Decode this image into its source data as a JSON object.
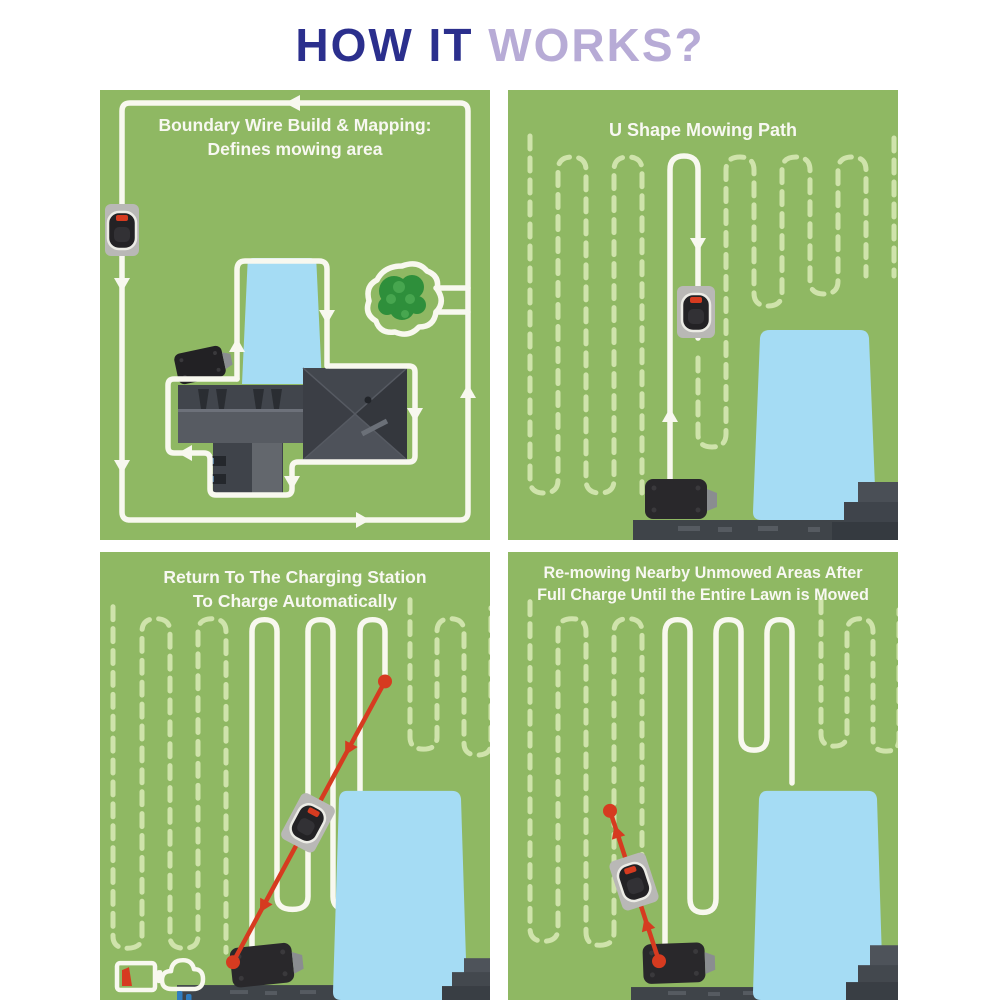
{
  "title": {
    "part1": "HOW IT",
    "part2": " WORKS?"
  },
  "panels": {
    "boundary": {
      "line1": "Boundary Wire Build & Mapping:",
      "line2": "Defines mowing area"
    },
    "ushape": {
      "line1": "U Shape Mowing Path",
      "line2": ""
    },
    "return_station": {
      "line1": "Return To The Charging Station",
      "line2": "To Charge Automatically"
    },
    "remowing": {
      "line1": "Re-mowing Nearby Unmowed Areas After",
      "line2": "Full Charge Until the Entire Lawn is Mowed"
    }
  },
  "colors": {
    "title_primary": "#2b2f8d",
    "title_secondary": "#b7abd6",
    "lawn_green": "#8fb863",
    "mowed_path_white": "#f8f8ef",
    "unmowed_dash_green": "#cfe3ab",
    "pool_blue": "#a5dcf4",
    "route_red": "#d63b20",
    "panel_title_white": "#f8f8f2",
    "station_black": "#29282b",
    "roof_gray": "#43474e"
  },
  "legend_icons": {
    "low_battery": "battery-low-icon",
    "rain_delay": "rain-cloud-icon"
  }
}
